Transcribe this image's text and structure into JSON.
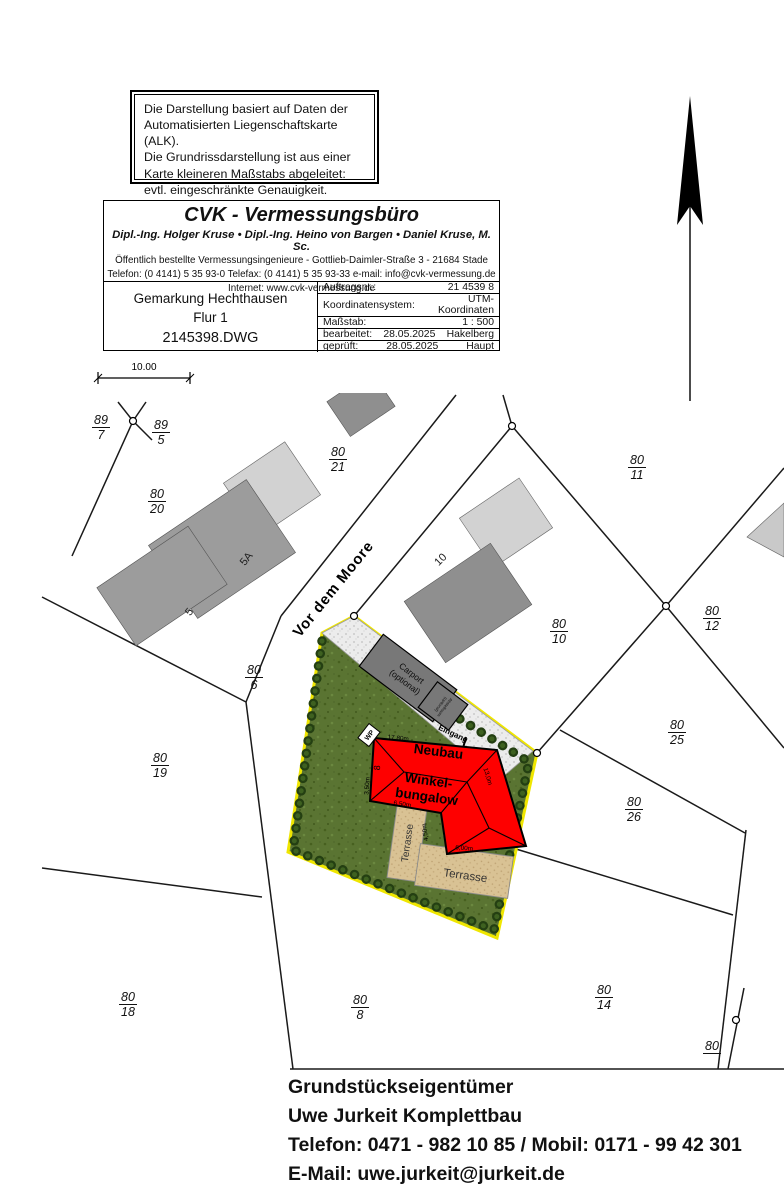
{
  "disclaimer": {
    "lines": [
      "Die Darstellung basiert auf Daten der",
      "Automatisierten Liegenschaftskarte (ALK).",
      "Die Grundrissdarstellung ist aus einer",
      "Karte kleineren Maßstabs abgeleitet:",
      "evtl. eingeschränkte Genauigkeit."
    ]
  },
  "firm": {
    "title": "CVK - Vermessungsbüro",
    "partners": "Dipl.-Ing. Holger Kruse • Dipl.-Ing. Heino von Bargen • Daniel Kruse, M. Sc.",
    "line1": "Öffentlich bestellte Vermessungsingenieure - Gottlieb-Daimler-Straße 3 - 21684 Stade",
    "line2": "Telefon: (0 4141) 5 35 93-0  Telefax: (0 4141) 5 35 93-33 e-mail: info@cvk-vermessung.de",
    "line3": "Internet: www.cvk-vermessung.de"
  },
  "sheet": {
    "gemarkung": "Gemarkung Hechthausen",
    "flur": "Flur 1",
    "file": "2145398.DWG"
  },
  "meta": {
    "rows": [
      {
        "label": "Auftragsnr.:",
        "mid": "",
        "value": "21 4539 8"
      },
      {
        "label": "Koordinatensystem:",
        "mid": "",
        "value": "UTM-Koordinaten"
      },
      {
        "label": "Maßstab:",
        "mid": "",
        "value": "1 : 500"
      },
      {
        "label": "bearbeitet:",
        "mid": "28.05.2025",
        "value": "Hakelberg"
      },
      {
        "label": "geprüft:",
        "mid": "28.05.2025",
        "value": "Haupt"
      }
    ]
  },
  "scalebar": {
    "label": "10.00"
  },
  "street": {
    "name": "Vor dem Moore"
  },
  "parcels": [
    {
      "num": "89",
      "den": "7"
    },
    {
      "num": "89",
      "den": "5"
    },
    {
      "num": "80",
      "den": "21"
    },
    {
      "num": "80",
      "den": "11"
    },
    {
      "num": "80",
      "den": "20"
    },
    {
      "num": "80",
      "den": "10"
    },
    {
      "num": "80",
      "den": "12"
    },
    {
      "num": "80",
      "den": "6"
    },
    {
      "num": "80",
      "den": "25"
    },
    {
      "num": "80",
      "den": "19"
    },
    {
      "num": "80",
      "den": "26"
    },
    {
      "num": "80",
      "den": "18"
    },
    {
      "num": "80",
      "den": "8"
    },
    {
      "num": "80",
      "den": "14"
    },
    {
      "num": "80",
      "den": ""
    }
  ],
  "houses": {
    "h5": "5",
    "h5a": "5A",
    "h10": "10"
  },
  "site": {
    "neubau": "Neubau",
    "winkel": "Winkel-",
    "bungalow": "bungalow",
    "dim_top": "17,80m",
    "dim_right": "13,0m",
    "dim_bottom": "6,00m",
    "dim_inner_v": "4,50m",
    "dim_inner_h": "6,50m",
    "dim_left": "3,50m",
    "dim_left2": "8",
    "carport_line1": "Carport",
    "carport_line2": "(optional)",
    "shed_line1": "Abstellraum",
    "shed_line2": "(optional)",
    "entrance": "Eingang",
    "heatpump": "WP",
    "terrace_upper": "Terrasse",
    "terrace_lower": "Terrasse"
  },
  "owner": {
    "lines": [
      "Grundstückseigentümer",
      "Uwe Jurkeit Komplettbau",
      "Telefon: 0471 - 982 10 85 / Mobil: 0171 - 99 42 301",
      "E-Mail: uwe.jurkeit@jurkeit.de"
    ]
  },
  "colors": {
    "house_red": "#fe0000",
    "boundary_yellow": "#efe600",
    "lawn_green": "#5a7432"
  }
}
